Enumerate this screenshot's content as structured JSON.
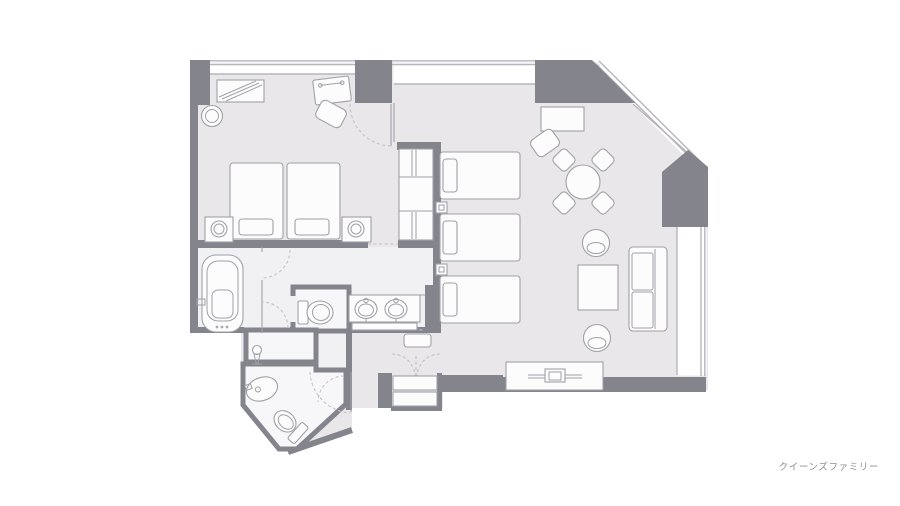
{
  "caption": "クイーンズファミリー",
  "palette": {
    "background": "#ffffff",
    "floor_main": "#e9e7e9",
    "floor_wet_area": "#f1f0f3",
    "floor_room": "#f7f6f8",
    "wall": "#84848d",
    "furniture_stroke": "#a0a0a8",
    "furniture_fill": "#fcfcfd",
    "window_line": "#b6b5bd",
    "door_arc": "#c3c2ca",
    "caption_color": "#90909a"
  },
  "fixtures": [
    "twin-bed",
    "twin-bed",
    "nightstand-lamp",
    "nightstand-lamp",
    "luggage-rack",
    "stool",
    "desk",
    "desk-chair",
    "wardrobe-closet",
    "single-bed",
    "single-bed",
    "single-bed",
    "reading-light",
    "reading-light",
    "writing-desk",
    "desk-chair",
    "round-dining-table",
    "dining-chair",
    "dining-chair",
    "dining-chair",
    "dining-chair",
    "armchair",
    "coffee-table",
    "armchair",
    "sofa",
    "tv-board",
    "bathtub",
    "toilet",
    "double-washbasin",
    "pedestal-basin",
    "corner-washbasin",
    "toilet",
    "entry-closet",
    "bench"
  ]
}
